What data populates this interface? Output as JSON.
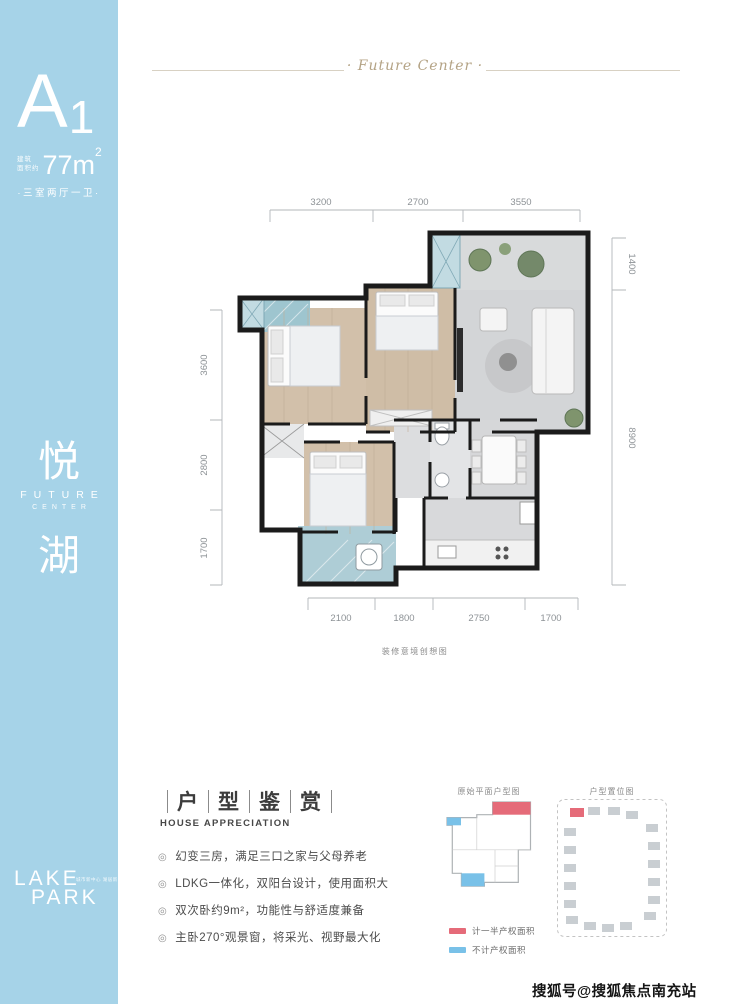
{
  "sidebar": {
    "unit_letter": "A",
    "unit_number": "1",
    "area_prefix": [
      "建筑",
      "面积约"
    ],
    "area_value": "77m",
    "area_sup": "2",
    "layout": "·三室两厅一卫·",
    "brand": {
      "char_top": "悦",
      "en1": "FUTURE",
      "en2": "CENTER",
      "char_bottom": "湖"
    },
    "logo": {
      "line1": "LAKE",
      "line2": "PARK",
      "tagline": "城市新中心 湖居新未来"
    }
  },
  "header": {
    "script_title": "· Future Center ·"
  },
  "floorplan": {
    "dims_top": [
      "3200",
      "2700",
      "3550"
    ],
    "dims_left": [
      "3600",
      "2800",
      "1700"
    ],
    "dims_right": [
      "1400",
      "8900"
    ],
    "dims_bottom": [
      "2100",
      "1800",
      "2750",
      "1700"
    ],
    "caption": "装修意境创想图"
  },
  "appreciation": {
    "title_chars": [
      "户",
      "型",
      "鉴",
      "赏"
    ],
    "subtitle": "HOUSE APPRECIATION",
    "bullet_icon": "◎",
    "bullets": [
      "幻变三房，满足三口之家与父母养老",
      "LDKG一体化，双阳台设计，使用面积大",
      "双次卧约9m²，功能性与舒适度兼备",
      "主卧270°观景窗，将采光、视野最大化"
    ]
  },
  "diagrams": {
    "left_label": "原始平面户型图",
    "right_label": "户型置位图",
    "legend": [
      {
        "color": "#e56b79",
        "label": "计一半产权面积"
      },
      {
        "color": "#79c1e8",
        "label": "不计产权面积"
      }
    ]
  },
  "watermark": {
    "text": "搜狐号@搜狐焦点南充站"
  },
  "colors": {
    "sidebar_blue": "#a6d3e8",
    "accent_red": "#e56b79",
    "accent_blue": "#79c1e8",
    "script_gold": "#b4a385",
    "wall_black": "#1b1b1b",
    "wood_floor": "#d0bea7",
    "gray_floor": "#d5d6d8",
    "balcony_teal": "#9ec5cf"
  }
}
